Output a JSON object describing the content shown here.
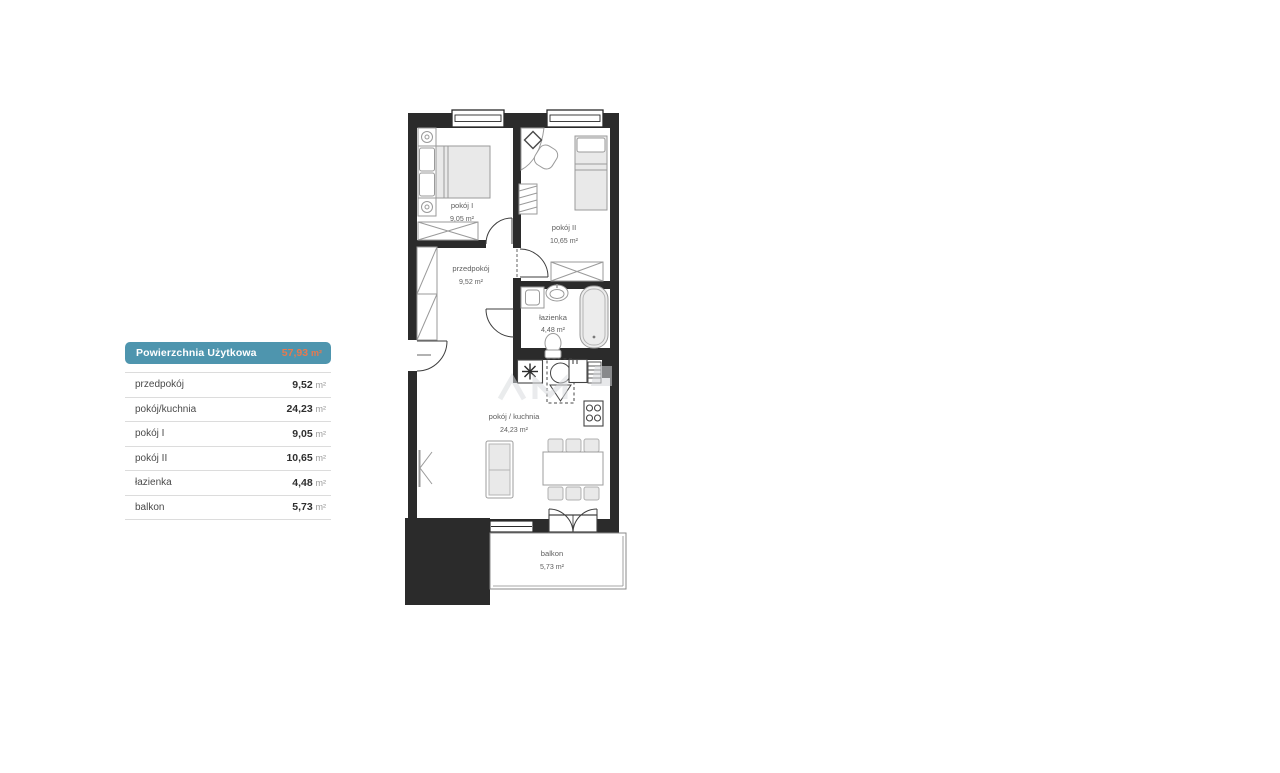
{
  "legend": {
    "header": {
      "label": "Powierzchnia Użytkowa",
      "value": "57,93",
      "unit": "m²"
    },
    "rows": [
      {
        "label": "przedpokój",
        "value": "9,52",
        "unit": "m²"
      },
      {
        "label": "pokój/kuchnia",
        "value": "24,23",
        "unit": "m²"
      },
      {
        "label": "pokój I",
        "value": "9,05",
        "unit": "m²"
      },
      {
        "label": "pokój II",
        "value": "10,65",
        "unit": "m²"
      },
      {
        "label": "łazienka",
        "value": "4,48",
        "unit": "m²"
      },
      {
        "label": "balkon",
        "value": "5,73",
        "unit": "m²"
      }
    ]
  },
  "floorplan": {
    "rooms": [
      {
        "name": "pokój I",
        "area": "9,05 m²"
      },
      {
        "name": "pokój II",
        "area": "10,65 m²"
      },
      {
        "name": "przedpokój",
        "area": "9,52 m²"
      },
      {
        "name": "łazienka",
        "area": "4,48 m²"
      },
      {
        "name": "pokój / kuchnia",
        "area": "24,23 m²"
      },
      {
        "name": "balkon",
        "area": "5,73 m²"
      }
    ]
  },
  "colors": {
    "header_bg": "#4e95ae",
    "header_value": "#e8794e",
    "walls": "#2b2b2b"
  }
}
